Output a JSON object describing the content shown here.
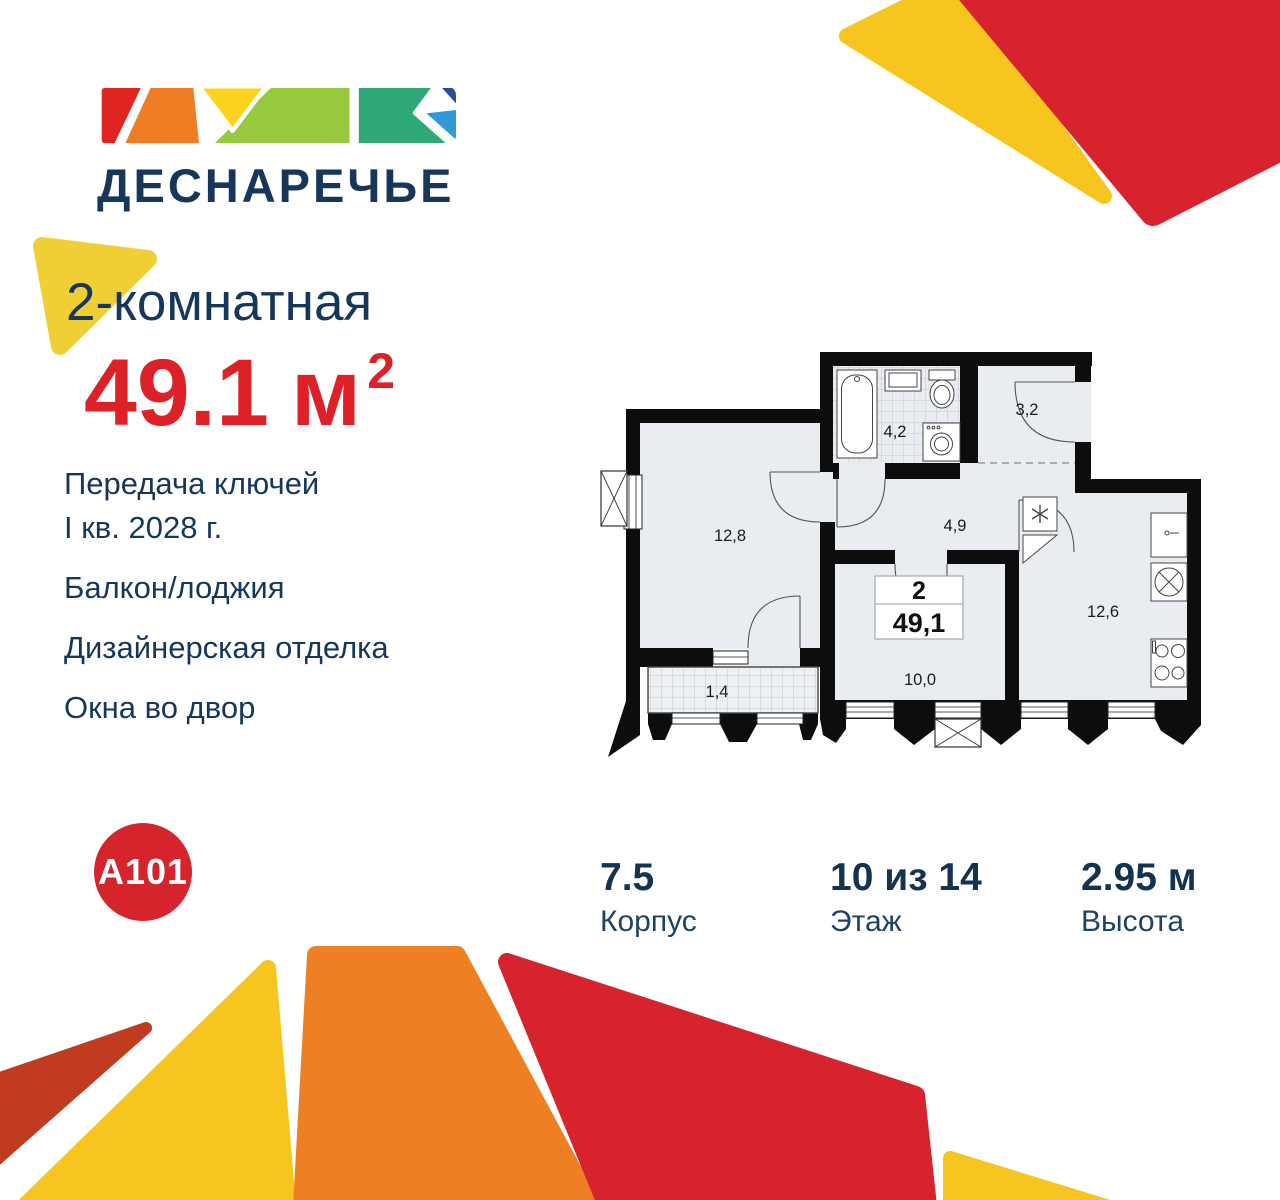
{
  "brand": {
    "name": "ДЕСНАРЕЧЬЕ"
  },
  "developer": {
    "logo_text": "A101"
  },
  "listing": {
    "type_title": "2-комнатная",
    "area": {
      "value": "49.1",
      "unit": "м",
      "superscript": "2"
    },
    "features": [
      "Передача ключей\nI кв. 2028 г.",
      "Балкон/лоджия",
      "Дизайнерская отделка",
      "Окна во двор"
    ]
  },
  "stats": [
    {
      "value": "7.5",
      "label": "Корпус"
    },
    {
      "value": "10 из 14",
      "label": "Этаж"
    },
    {
      "value": "2.95 м",
      "label": "Высота"
    }
  ],
  "floorplan": {
    "badge": {
      "rooms_count": "2",
      "total_area": "49,1"
    },
    "room_areas": {
      "living_room": "12,8",
      "bathroom": "4,2",
      "entry_hall": "3,2",
      "corridor": "4,9",
      "bedroom": "10,0",
      "kitchen": "12,6",
      "balcony": "1,4"
    },
    "icons": [
      "bathtub-icon",
      "bath-sink-icon",
      "toilet-icon",
      "washing-machine-icon",
      "fridge-icon",
      "kitchen-sink-icon",
      "hob-icon",
      "stove-icon",
      "vent-shaft-icon"
    ]
  },
  "colors": {
    "navy_text": "#16375A",
    "accent_red": "#DD2127",
    "brand_red": "#D6232E",
    "orange": "#EE8023",
    "yellow": "#F6C51F",
    "dark_brick": "#C13B21",
    "plan_wall": "#0D0D0D",
    "plan_room_fill": "#E9EDF1"
  }
}
